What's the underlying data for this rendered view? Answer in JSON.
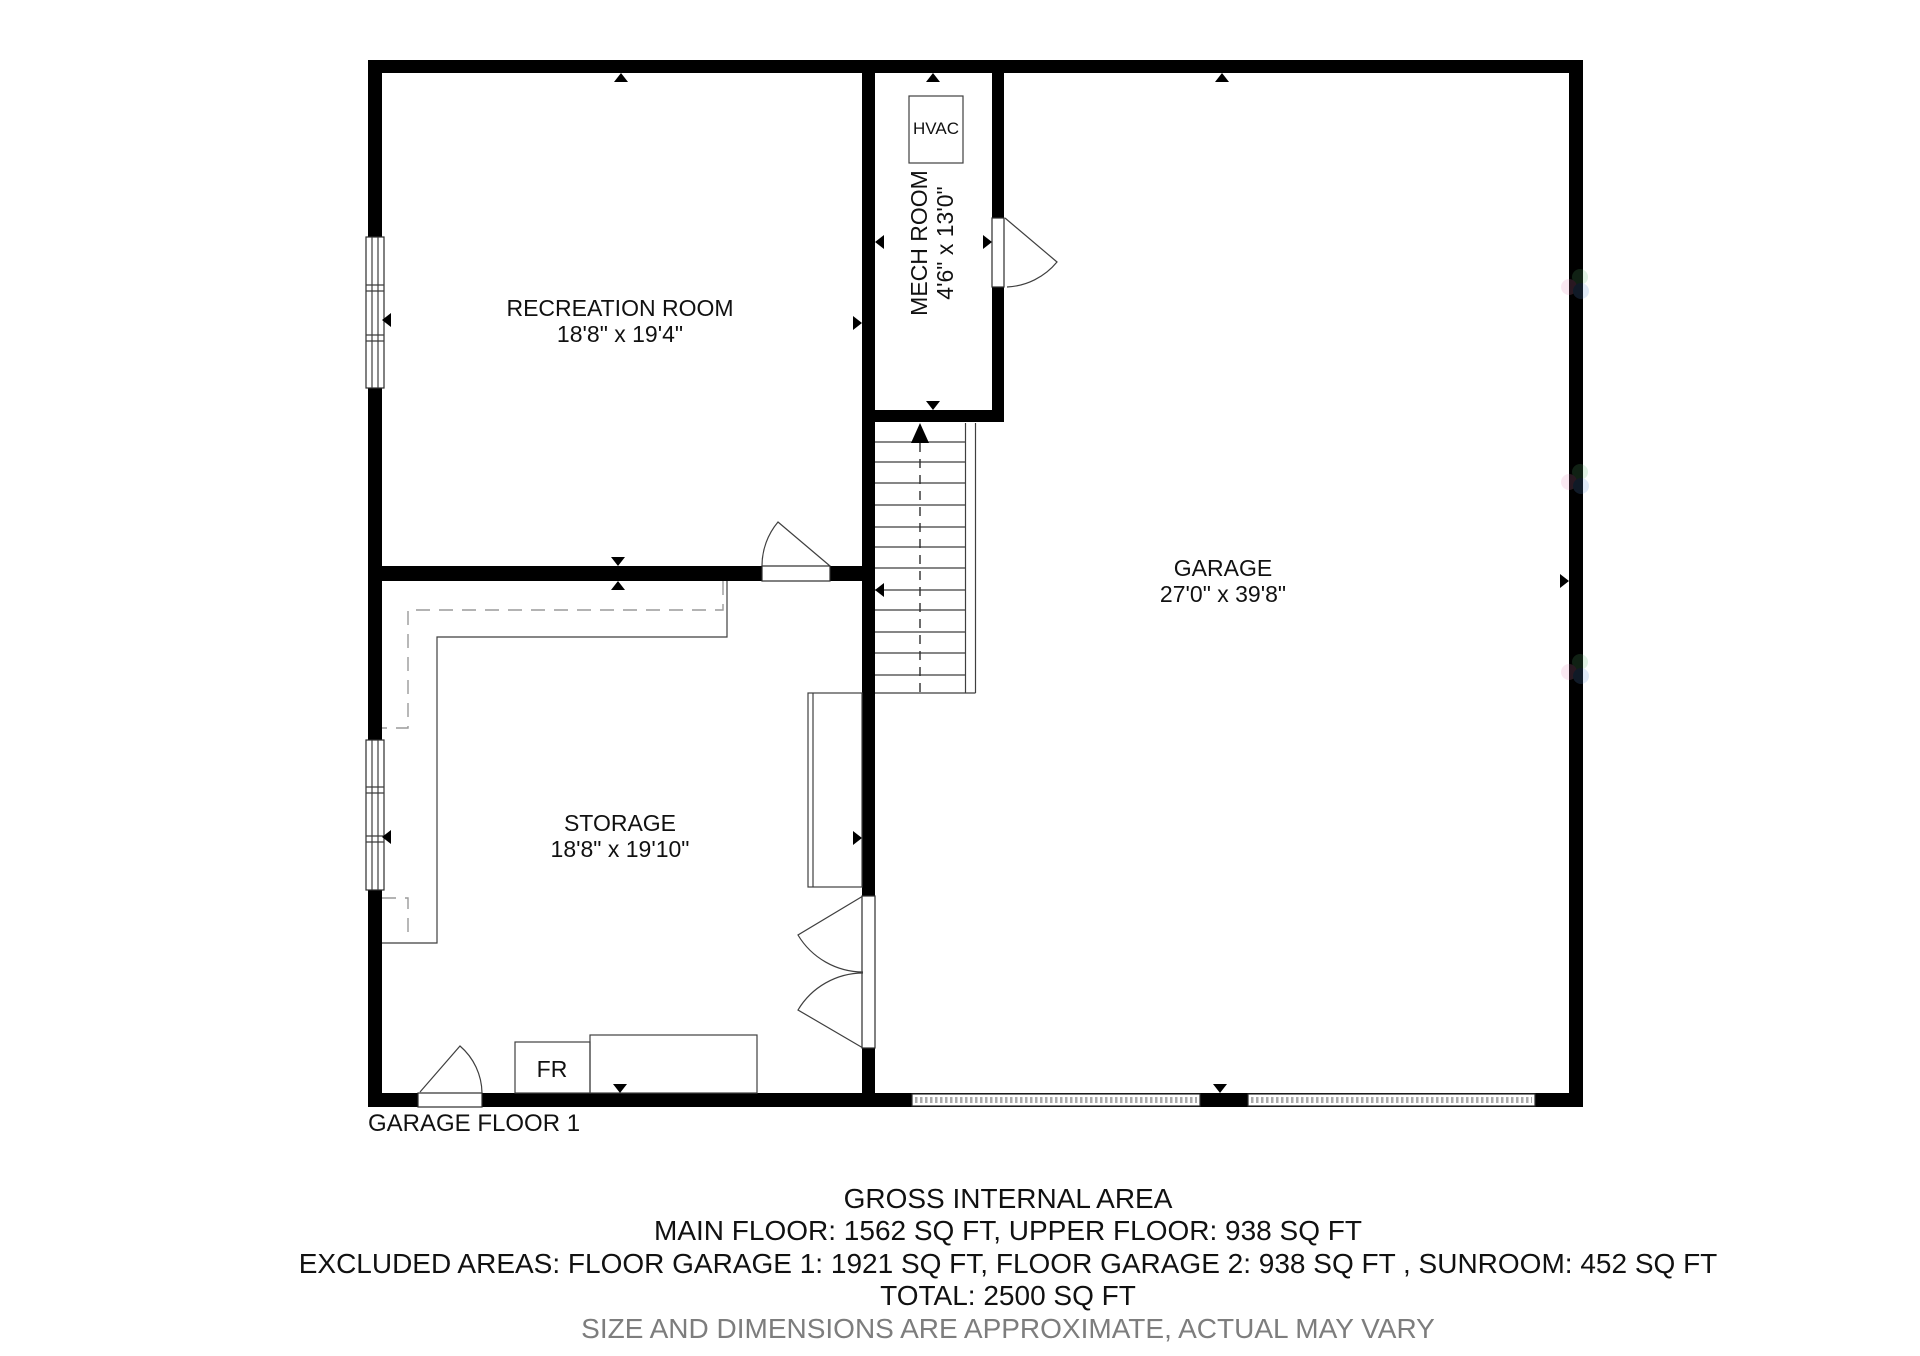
{
  "floor_label": "GARAGE FLOOR 1",
  "rooms": {
    "recreation": {
      "name": "RECREATION ROOM",
      "dims": "18'8\" x 19'4\""
    },
    "mech": {
      "name": "MECH ROOM",
      "dims": "4'6\" x 13'0\""
    },
    "garage": {
      "name": "GARAGE",
      "dims": "27'0\" x 39'8\""
    },
    "storage": {
      "name": "STORAGE",
      "dims": "18'8\" x 19'10\""
    }
  },
  "fixtures": {
    "hvac_label": "HVAC",
    "fr_label": "FR"
  },
  "summary": {
    "title": "GROSS INTERNAL AREA",
    "line1": "MAIN FLOOR: 1562 SQ FT, UPPER FLOOR: 938 SQ FT",
    "line2": "EXCLUDED AREAS: FLOOR GARAGE 1: 1921 SQ FT, FLOOR GARAGE 2: 938 SQ FT , SUNROOM: 452 SQ FT",
    "line3": "TOTAL: 2500 SQ FT",
    "disclaimer": "SIZE AND DIMENSIONS ARE APPROXIMATE, ACTUAL MAY VARY"
  },
  "colors": {
    "wall": "#000000",
    "thin_line": "#3f3f3f",
    "dashed_line": "#9a9a9a",
    "garage_door_hatch": "#ababab",
    "disclaimer_text": "#7d7d7d",
    "background": "#ffffff"
  }
}
